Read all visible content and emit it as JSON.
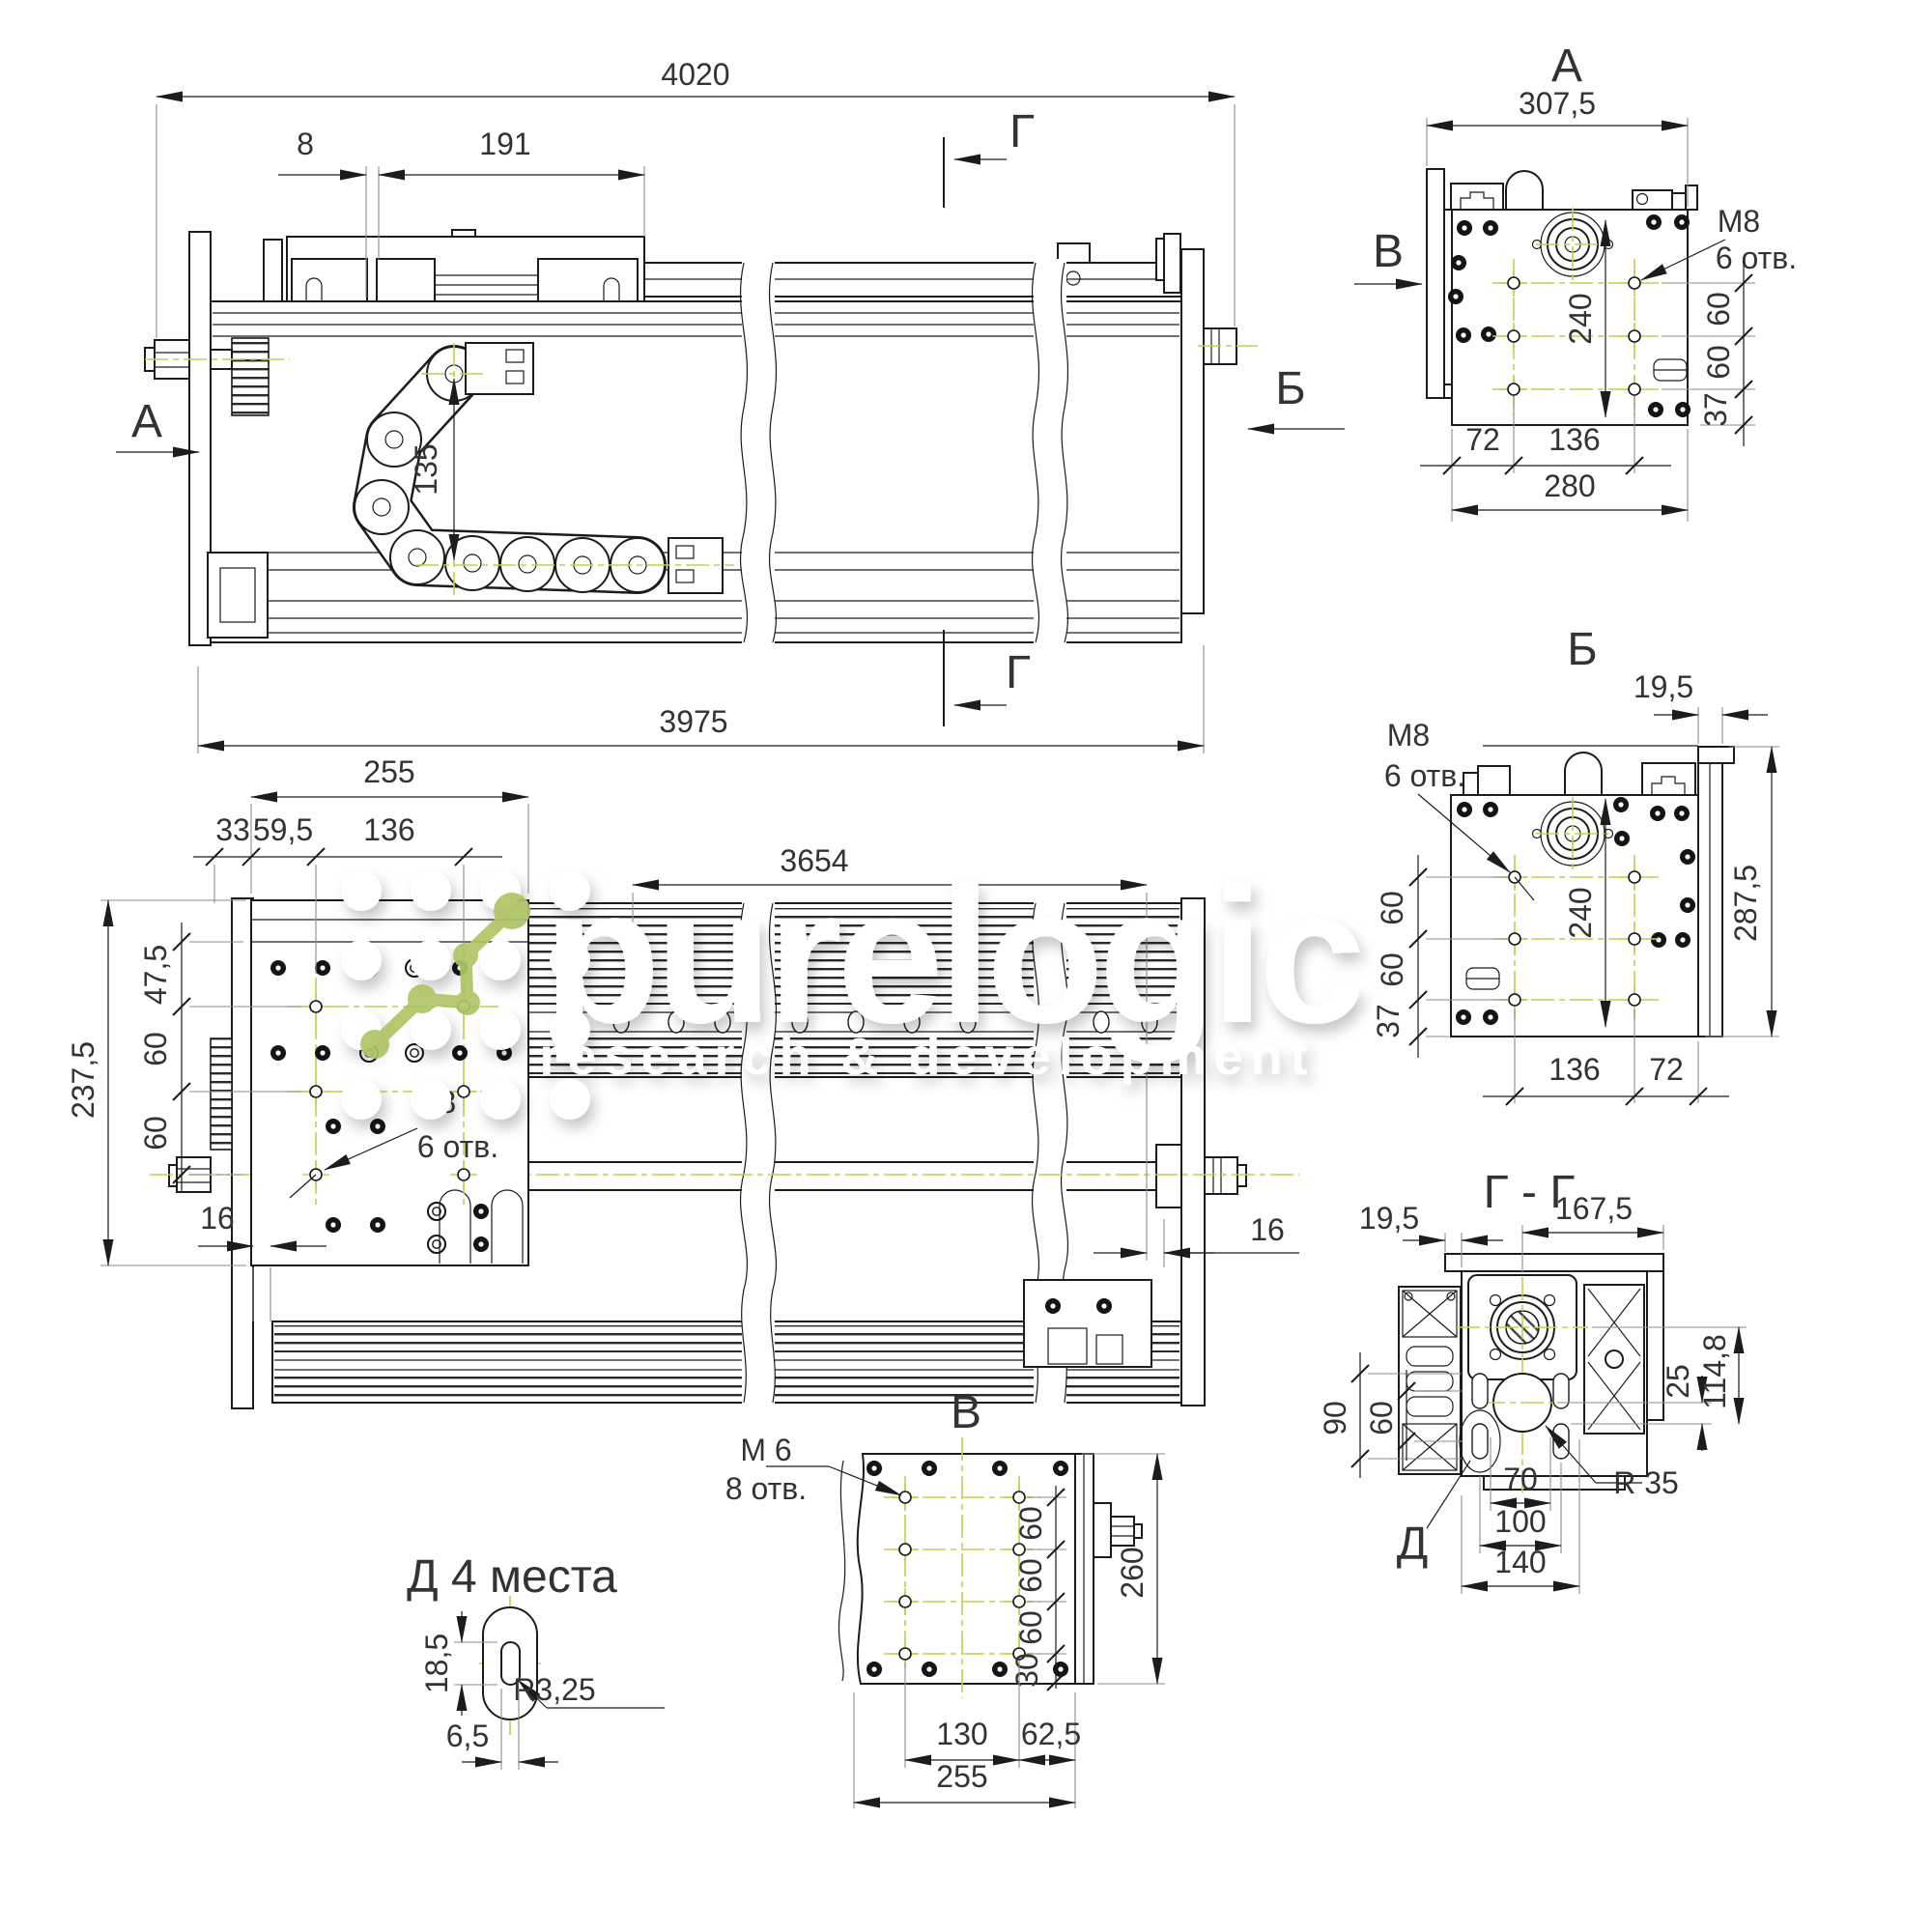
{
  "watermark": {
    "brand": "purelogic",
    "tagline": "research & development"
  },
  "colors": {
    "line": "#1c1c1c",
    "centerline": "#c3cf4a",
    "logo_green": "#aec566",
    "extension_gray": "#8d8d8d"
  },
  "front_view": {
    "labels": {
      "view_left": "А",
      "view_right": "Б",
      "section_top": "Г",
      "section_bottom": "Г"
    },
    "dims": {
      "overall": "4020",
      "motor_offset": "8",
      "carriage": "191",
      "chain_height": "135",
      "body_length": "3975"
    }
  },
  "plan_view": {
    "thread": {
      "label": "М8",
      "holes": "6 отв."
    },
    "dims": {
      "plate_width": "255",
      "left_offset": "33",
      "hole_offset": "59,5",
      "hole_spacing": "136",
      "travel": "3654",
      "plate_height": "237,5",
      "top_offset": "47,5",
      "row_spacing_1": "60",
      "row_spacing_2": "60",
      "edge_left": "16",
      "edge_right": "16"
    }
  },
  "view_a": {
    "title": "А",
    "view_dir": "В",
    "thread": {
      "label": "М8",
      "holes": "6 отв."
    },
    "dims": {
      "width": "307,5",
      "hole_span": "240",
      "row_1": "60",
      "row_2": "60",
      "bottom_offset": "37",
      "col_offset": "72",
      "col_spacing": "136",
      "base_width": "280"
    }
  },
  "view_b": {
    "title": "Б",
    "thread": {
      "label": "М8",
      "holes": "6 отв."
    },
    "dims": {
      "cover": "19,5",
      "hole_span": "240",
      "height": "287,5",
      "row_1": "60",
      "row_2": "60",
      "bottom_offset": "37",
      "col_spacing": "136",
      "col_offset": "72"
    }
  },
  "section_gg": {
    "title": "Г - Г",
    "detail_mark": "Д",
    "radius": "R 35",
    "dims": {
      "cover": "19,5",
      "width": "167,5",
      "offset_25": "25",
      "height_114_8": "114,8",
      "span_90": "90",
      "span_60": "60",
      "hole_70": "70",
      "slot_100": "100",
      "base_140": "140"
    }
  },
  "view_v": {
    "title": "В",
    "thread": {
      "label": "М 6",
      "holes": "8 отв."
    },
    "dims": {
      "row_1": "60",
      "row_2": "60",
      "row_3": "60",
      "bottom_offset": "30",
      "height": "260",
      "col_spacing": "130",
      "col_offset": "62,5",
      "width": "255"
    }
  },
  "detail_d": {
    "title": "Д 4 места",
    "dims": {
      "slot_length": "18,5",
      "radius": "R3,25",
      "slot_width": "6,5"
    }
  }
}
